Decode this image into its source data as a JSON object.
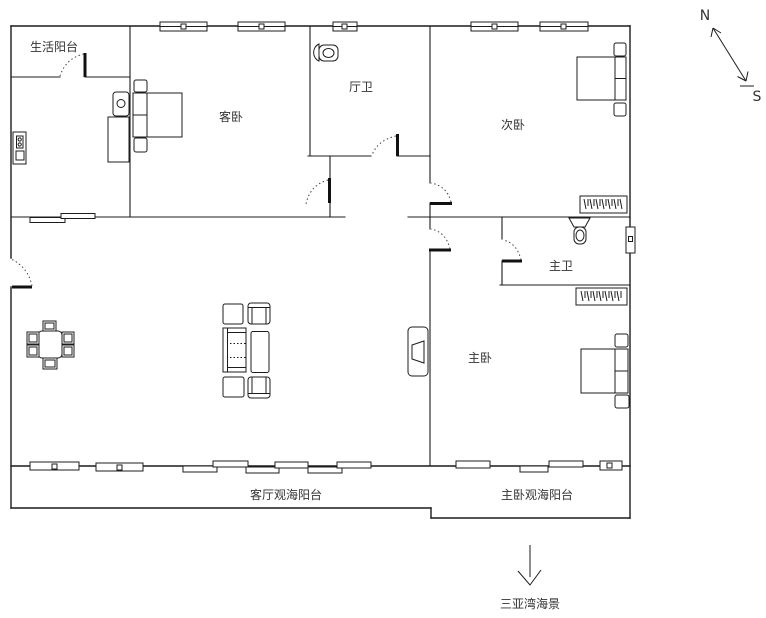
{
  "floorplan": {
    "rooms": [
      {
        "id": "life-balcony",
        "label": "生活阳台"
      },
      {
        "id": "guest-bedroom",
        "label": "客卧"
      },
      {
        "id": "hall-bathroom",
        "label": "厅卫"
      },
      {
        "id": "second-bedroom",
        "label": "次卧"
      },
      {
        "id": "master-bathroom",
        "label": "主卫"
      },
      {
        "id": "master-bedroom",
        "label": "主卧"
      },
      {
        "id": "living-view-balcony",
        "label": "客厅观海阳台"
      },
      {
        "id": "master-view-balcony",
        "label": "主卧观海阳台"
      }
    ],
    "compass": {
      "north_label": "N",
      "south_label": "S"
    },
    "sea_view_caption": "三亚湾海景",
    "colors": {
      "line": "#1c1c1c",
      "text": "#333333",
      "background": "#ffffff"
    }
  }
}
